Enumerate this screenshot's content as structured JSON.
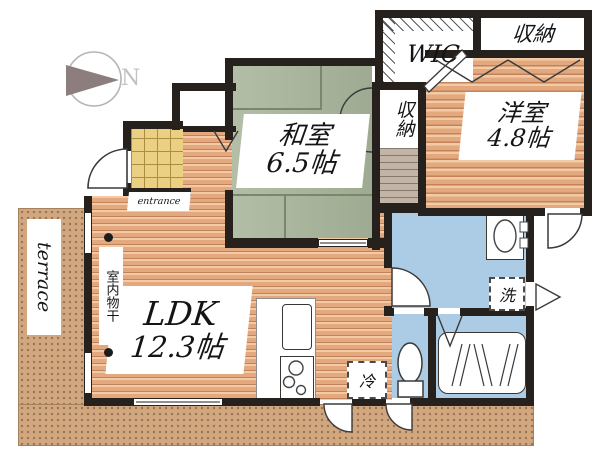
{
  "compass": {
    "label": "N"
  },
  "rooms": {
    "washitsu": {
      "name": "和室",
      "size": "6.5帖"
    },
    "yoshitsu": {
      "name": "洋室",
      "size": "4.8帖"
    },
    "ldk": {
      "name": "LDK",
      "size": "12.3帖"
    },
    "wic": {
      "label": "WIC"
    },
    "storage_top_right": {
      "label": "収納"
    },
    "storage_middle": {
      "label": "収納"
    }
  },
  "fixtures": {
    "washer": {
      "label": "洗"
    },
    "fridge": {
      "label": "冷"
    },
    "indoor_drying": {
      "label": "室内物干"
    }
  },
  "outdoor": {
    "terrace": {
      "label": "terrace"
    },
    "entrance": {
      "label": "entrance"
    }
  },
  "colors": {
    "wall": "#26211d",
    "wood_floor": "#e8b48e",
    "tatami_green": "#a8b59a",
    "water_blue": "#abcce4",
    "terrace_sand": "#d0a77f",
    "entry_tile": "#ebd084"
  }
}
